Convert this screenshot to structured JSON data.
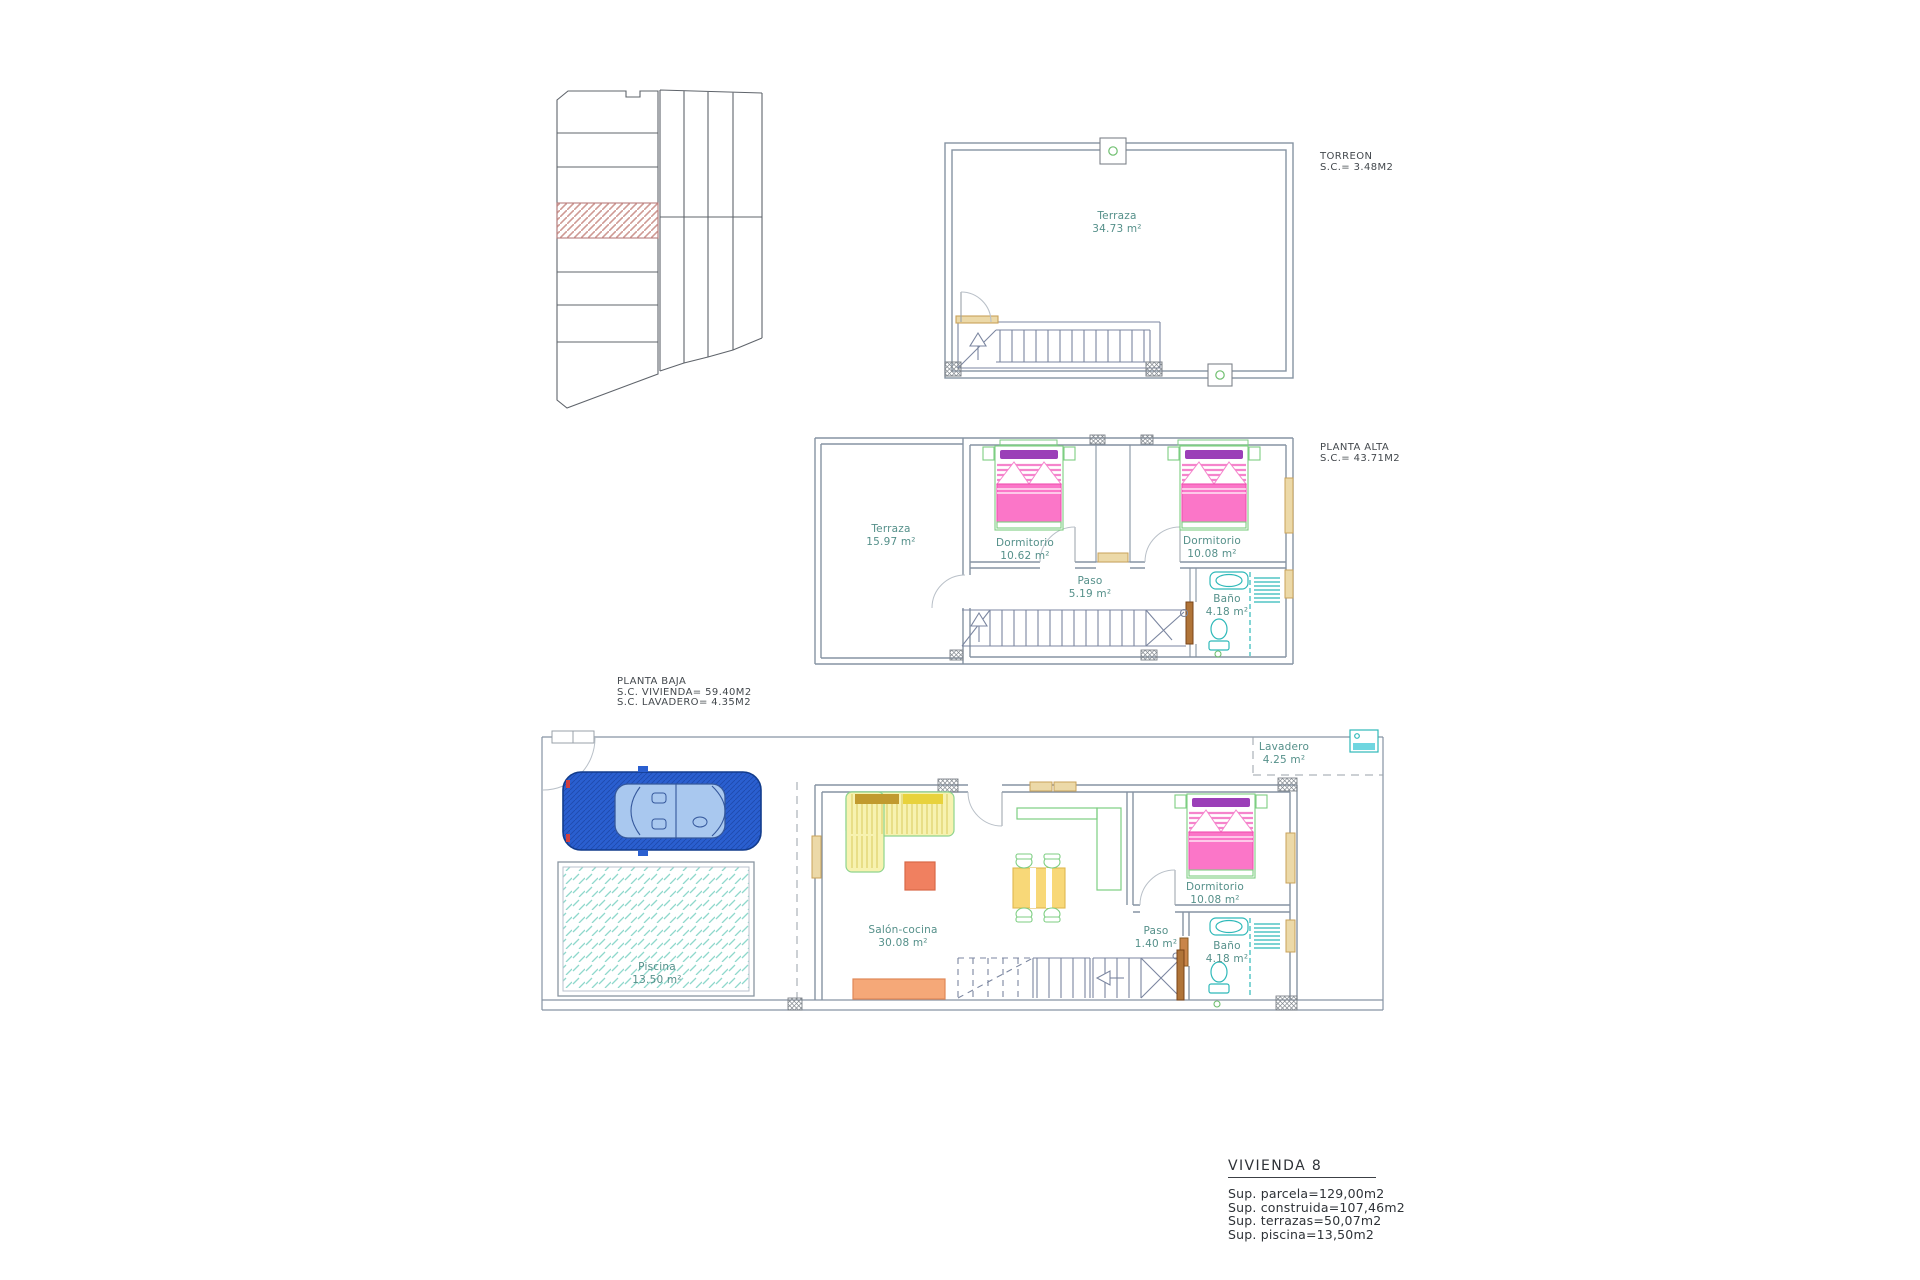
{
  "sheet": {
    "description": "Architectural floor-plan sheet for townhouse VIVIENDA 8"
  },
  "torreon": {
    "title": "TORREON",
    "area_label": "S.C.=  3.48M2",
    "rooms": [
      {
        "name": "Terraza",
        "area": "34.73 m²"
      }
    ]
  },
  "planta_alta": {
    "title": "PLANTA ALTA",
    "area_label": "S.C.=  43.71M2",
    "rooms": [
      {
        "name": "Terraza",
        "area": "15.97 m²"
      },
      {
        "name": "Dormitorio",
        "area": "10.62 m²"
      },
      {
        "name": "Dormitorio",
        "area": "10.08 m²"
      },
      {
        "name": "Paso",
        "area": "5.19 m²"
      },
      {
        "name": "Baño",
        "area": "4.18 m²"
      }
    ]
  },
  "planta_baja": {
    "title": "PLANTA BAJA",
    "area_labels": [
      "S.C. VIVIENDA=  59.40M2",
      "S.C. LAVADERO=  4.35M2"
    ],
    "rooms": [
      {
        "name": "Lavadero",
        "area": "4.25 m²"
      },
      {
        "name": "Salón-cocina",
        "area": "30.08 m²"
      },
      {
        "name": "Paso",
        "area": "1.40 m²"
      },
      {
        "name": "Dormitorio",
        "area": "10.08 m²"
      },
      {
        "name": "Baño",
        "area": "4.18 m²"
      },
      {
        "name": "Piscina",
        "area": "13.50 m²"
      }
    ]
  },
  "summary": {
    "title": "VIVIENDA 8",
    "lines": [
      "Sup.  parcela=129,00m2",
      "Sup.  construida=107,46m2",
      "Sup.  terrazas=50,07m2",
      "Sup.  piscina=13,50m2"
    ]
  },
  "colors": {
    "wall_gray": "#8693a3",
    "label_teal": "#55908a",
    "bed_pink": "#fb76c8",
    "pillow_purple": "#9b3fb8",
    "furniture_green": "#7dce82",
    "sofa_yellow": "#f7f2b0",
    "cushion_gold": "#c19a2e",
    "table_orange": "#f08060",
    "counter_orange": "#f5a878",
    "car_blue": "#2a5fd0",
    "pool_teal": "#8fd8cc",
    "bath_teal": "#2fb9b9",
    "wood_tan": "#c9a25a",
    "site_hatch_red": "#cf9a94"
  }
}
